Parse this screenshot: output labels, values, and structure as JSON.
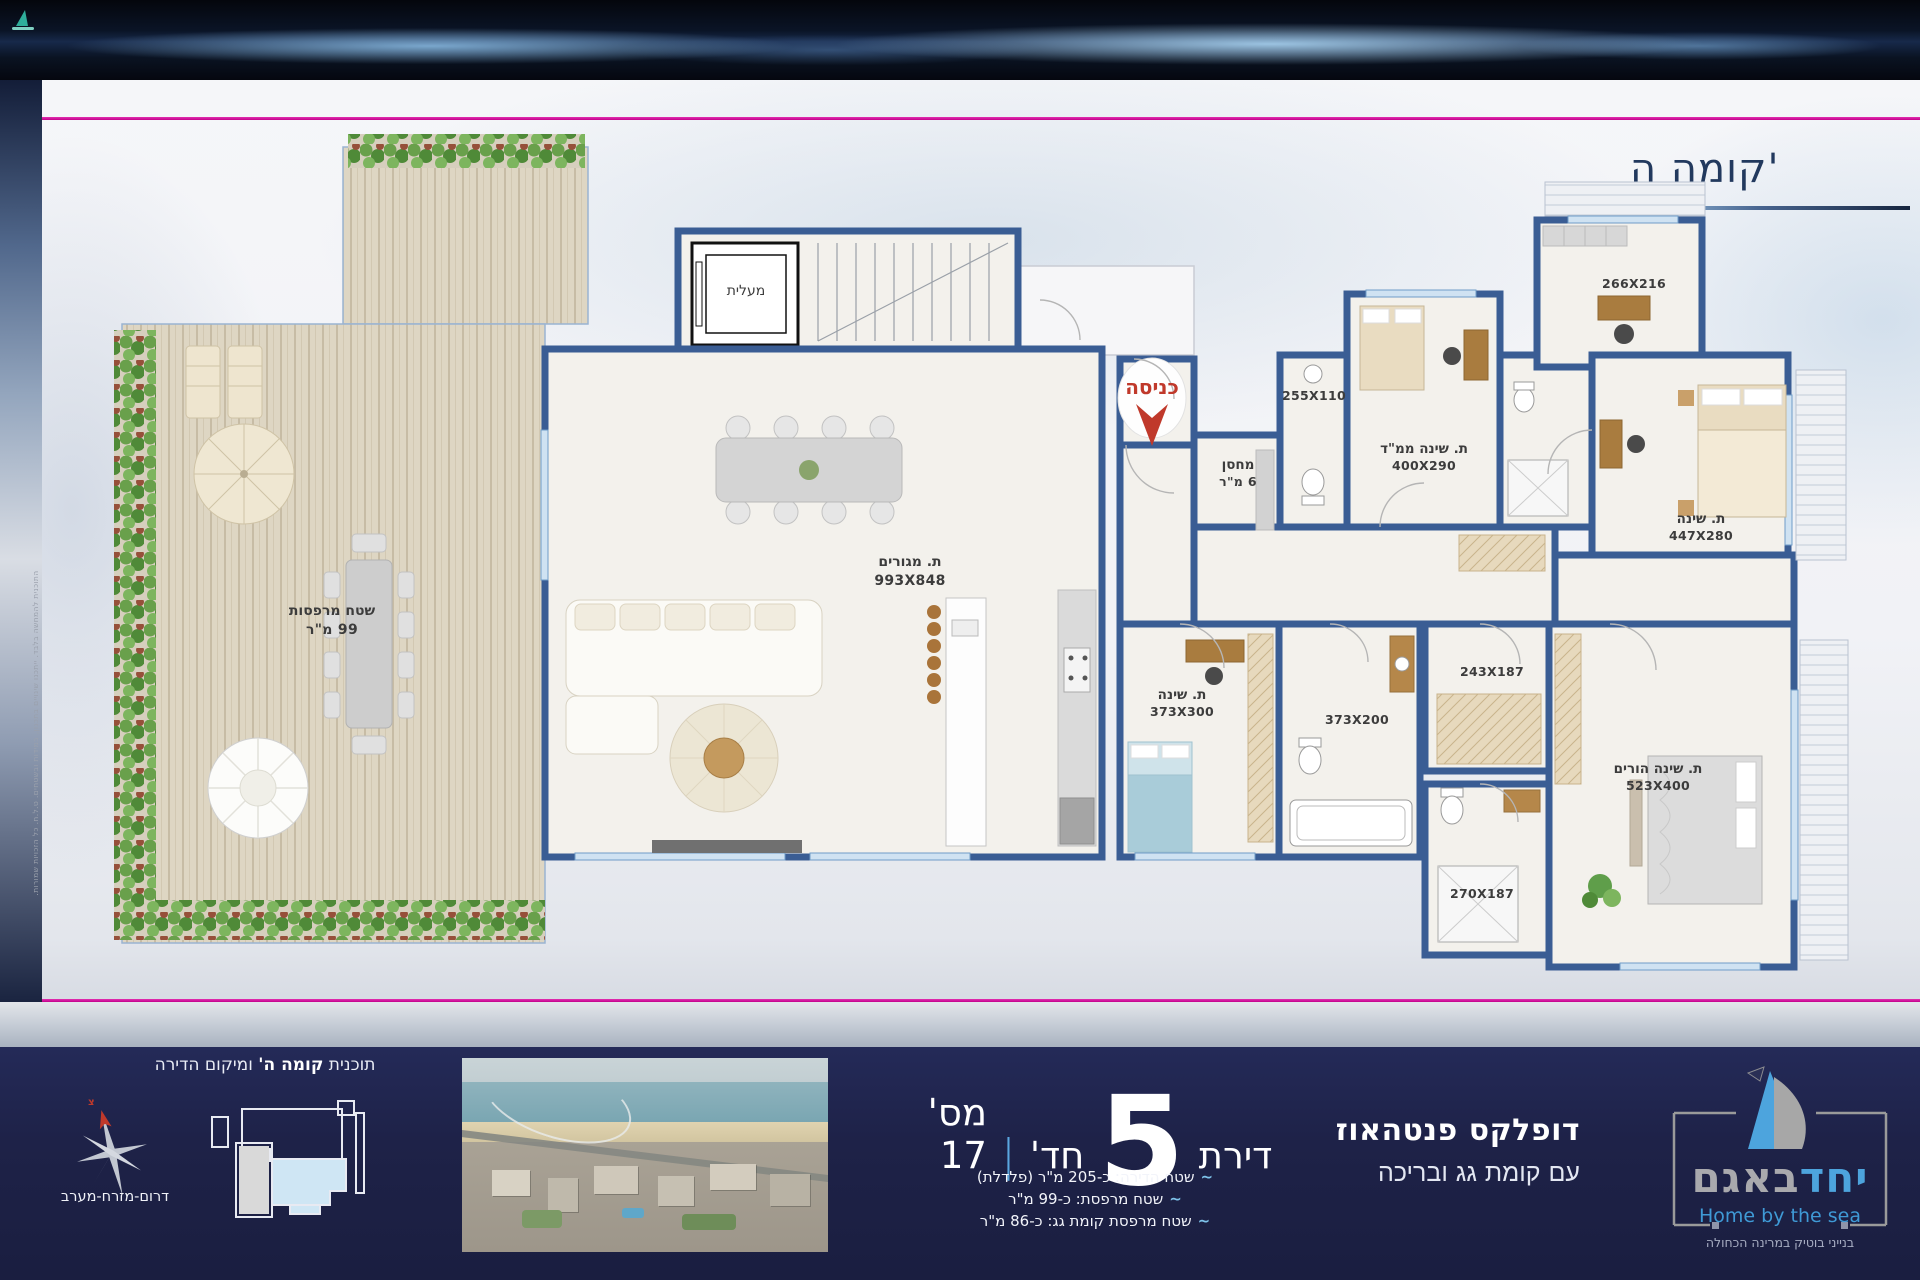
{
  "page": {
    "floor_title": "קומה ה'"
  },
  "plan": {
    "rooms": {
      "elevator": {
        "name": "מעלית"
      },
      "entrance": {
        "name": "כניסה"
      },
      "storage": {
        "name": "מחסן",
        "dims": "6 מ\"ר"
      },
      "living": {
        "name": "ת. מגורים",
        "dims": "993X848"
      },
      "terrace": {
        "name": "שטח מרפסות",
        "dims": "99 מ\"ר"
      },
      "mamad": {
        "name": "ת. שינה ממ\"ד",
        "dims": "400X290"
      },
      "bath_top": {
        "dims": "255X110"
      },
      "room_top_right": {
        "dims": "266X216"
      },
      "bedroom2": {
        "name": "ת. שינה",
        "dims": "447X280"
      },
      "bedroom3": {
        "name": "ת. שינה",
        "dims": "373X300"
      },
      "bath_mid": {
        "dims": "373X200"
      },
      "hall": {
        "dims": "243X187"
      },
      "parents": {
        "name": "ת. שינה הורים",
        "dims": "523X400"
      },
      "bath_parents": {
        "dims": "270X187"
      }
    },
    "disclaimer": "התוכנית להמחשה בלבד. ייתכנו שינויים בתכנון, במידות ובשטחים. ט.ל.ח. כל הזכויות שמורות."
  },
  "footer": {
    "location": {
      "title_pre": "תוכנית ",
      "title_bold": "קומה ה'",
      "title_post": " ומיקום הדירה",
      "orientation": "דרום-מזרח-מערב",
      "compass_letter": "צ"
    },
    "apt": {
      "word_apartment": "דירת",
      "rooms_count": "5",
      "word_rooms": "חד'",
      "divider": "|",
      "number_label": "מס' 17",
      "tilde": "~",
      "details": [
        {
          "text": "שטח הדירה:  כ-205 מ\"ר (פלדלת)"
        },
        {
          "text": "שטח מרפסת:  כ-99 מ\"ר"
        },
        {
          "text": "שטח מרפסת קומת גג:  כ-86 מ\"ר"
        }
      ]
    },
    "duplex": {
      "line1": "דופלקס פנטהאוז",
      "line2": "עם קומת גג ובריכה"
    },
    "logo": {
      "brand_blue": "יחד",
      "brand_gray": "באגם",
      "tagline": "Home by the sea",
      "subtitle": "בנייני בוטיק במרינה הכחולה"
    }
  },
  "colors": {
    "wall_blue": "#3a5d94",
    "accent_pink": "#c3008b",
    "footer_navy": "#1e2248",
    "logo_blue": "#4da4dd",
    "entrance_red": "#c0392b"
  }
}
